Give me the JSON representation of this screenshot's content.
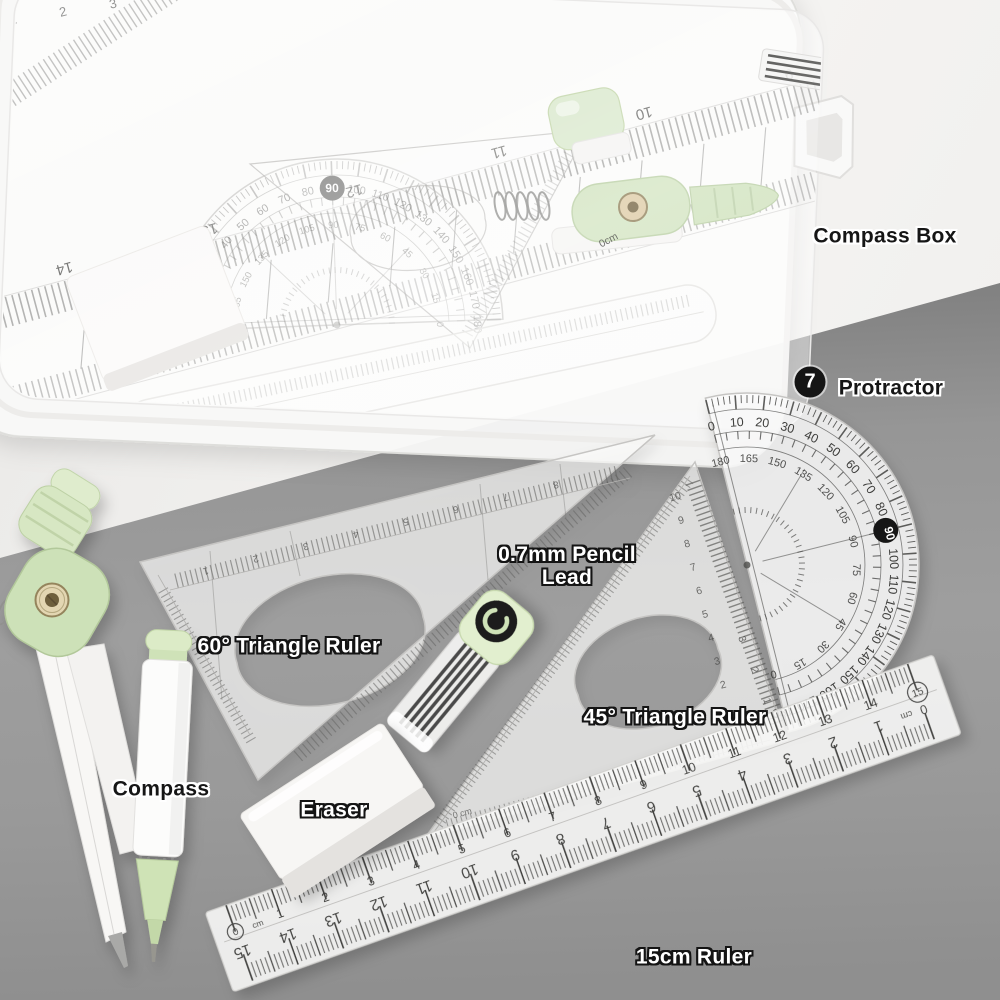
{
  "scene": {
    "desk_color": "#f0efed",
    "surface_color": "#969696",
    "accent_green": "#cfe2ba"
  },
  "labels": {
    "compass_box": "Compass Box",
    "protractor": "Protractor",
    "protractor_badge": "7",
    "pencil_lead_line1": "0.7mm Pencil",
    "pencil_lead_line2": "Lead",
    "triangle_60": "60° Triangle Ruler",
    "triangle_45": "45° Triangle Ruler",
    "eraser": "Eraser",
    "compass": "Compass",
    "ruler_15": "15cm Ruler"
  },
  "ruler15": {
    "zero": "0",
    "unit": "cm",
    "end": "15",
    "top_numbers": [
      "1",
      "2",
      "3",
      "4",
      "5",
      "6",
      "7",
      "8",
      "9",
      "10",
      "11",
      "12",
      "13",
      "14"
    ],
    "bottom_numbers": [
      "15",
      "14",
      "13",
      "12",
      "11",
      "10",
      "9",
      "8",
      "7",
      "6",
      "5",
      "4",
      "3",
      "2",
      "1"
    ],
    "bottom_zero": "0",
    "bottom_unit": "cm"
  },
  "protractor_dial": {
    "outer_numbers": [
      "0",
      "10",
      "20",
      "30",
      "40",
      "50",
      "60",
      "70",
      "80",
      "90",
      "100",
      "110",
      "120",
      "130",
      "140",
      "150",
      "160",
      "170",
      "180"
    ],
    "inner_numbers": [
      "180",
      "165",
      "150",
      "135",
      "120",
      "105",
      "90",
      "75",
      "60",
      "45",
      "30",
      "15",
      "0"
    ],
    "highlighted": "90"
  },
  "triangle45": {
    "left_scale": [
      "10",
      "9",
      "8",
      "7",
      "6",
      "5",
      "4",
      "3",
      "2"
    ],
    "right_scale": [
      "3",
      "2",
      "1",
      "0"
    ],
    "zero_mark": "0 cm"
  },
  "triangle60": {
    "top_scale": [
      "1",
      "2",
      "3",
      "4",
      "5",
      "6",
      "7",
      "8"
    ]
  },
  "box": {
    "ruler_inverted_numbers": [
      "14",
      "13",
      "12",
      "11",
      "10",
      "9",
      "8"
    ],
    "ruler_top_numbers": [
      "1",
      "2",
      "3"
    ],
    "ruler_zero_mark": "0cm"
  }
}
